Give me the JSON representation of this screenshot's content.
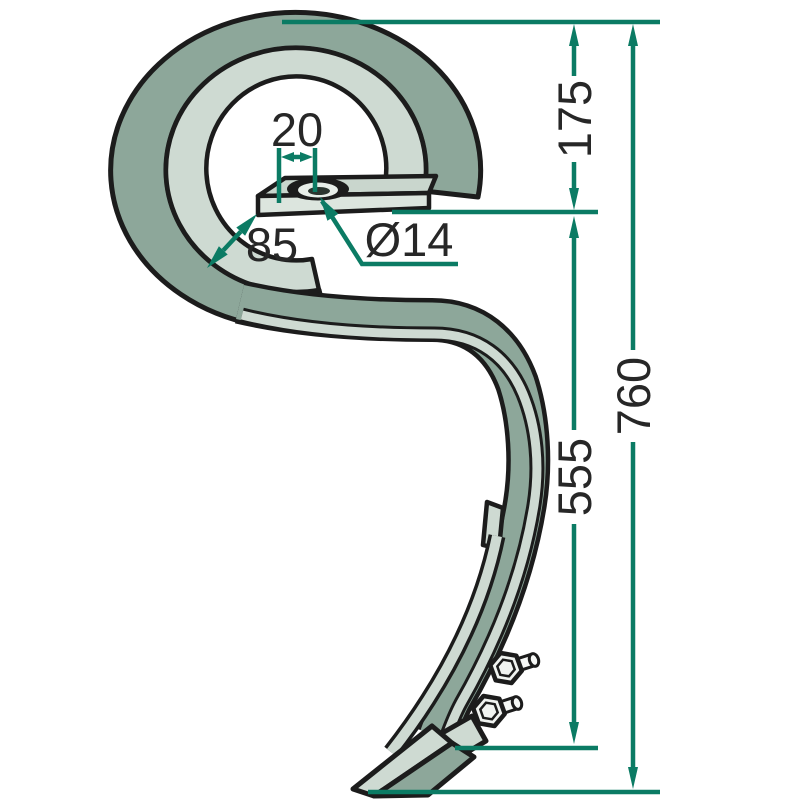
{
  "page": {
    "title": "Spring tine technical drawing"
  },
  "drawing": {
    "part_name": "S-shaped cultivator spring tine with mounting hole and bolted share point",
    "style": {
      "outline_color": "#1c1c1c",
      "face_color": "#8da79a",
      "edge_color": "#cedad2",
      "plate_top_color": "#c9d6cd",
      "plate_front_color": "#dce5de",
      "bolt_color": "#f0f3f0",
      "dimension_color": "#0b7b64",
      "text_color": "#272727",
      "background": "#ffffff"
    },
    "dimensions": [
      {
        "id": "hole-offset",
        "label": "20",
        "orientation": "horizontal"
      },
      {
        "id": "hole-diameter",
        "label": "Ø14",
        "orientation": "leader"
      },
      {
        "id": "strip-width",
        "label": "85",
        "orientation": "diagonal"
      },
      {
        "id": "upper-section",
        "label": "175",
        "orientation": "vertical"
      },
      {
        "id": "lower-section",
        "label": "555",
        "orientation": "vertical"
      },
      {
        "id": "overall-length",
        "label": "760",
        "orientation": "vertical"
      }
    ]
  }
}
